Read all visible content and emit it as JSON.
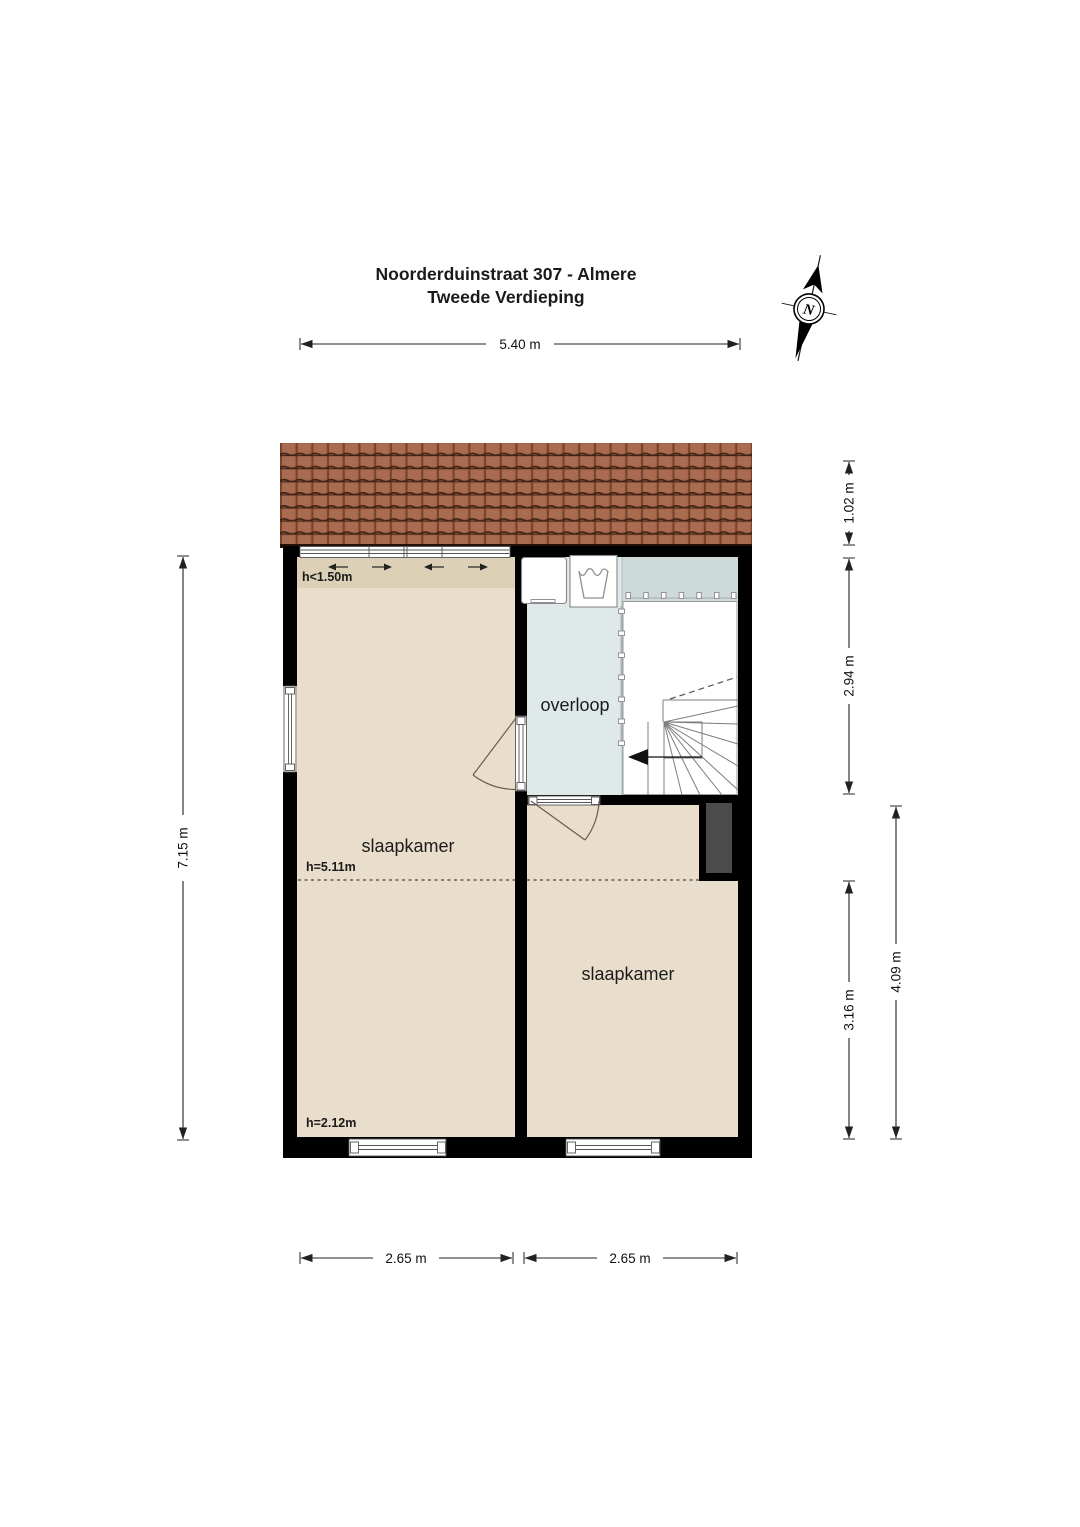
{
  "title": {
    "line1": "Noorderduinstraat 307 - Almere",
    "line2": "Tweede Verdieping"
  },
  "compass": {
    "label": "N"
  },
  "dims": {
    "top": "5.40 m",
    "left": "7.15 m",
    "right_roof": "1.02 m",
    "right_landing": "2.94 m",
    "right_room": "3.16 m",
    "right_total": "4.09 m",
    "bottom_left": "2.65 m",
    "bottom_right": "2.65 m"
  },
  "rooms": {
    "bedroom_left": {
      "label": "slaapkamer"
    },
    "bedroom_right": {
      "label": "slaapkamer"
    },
    "landing": {
      "label": "overloop"
    }
  },
  "notes": {
    "low_headroom": "h<1.50m",
    "ridge_height": "h=5.11m",
    "knee_height": "h=2.12m"
  },
  "colors": {
    "wall": "#000000",
    "bedroom_floor": "#e9decb",
    "bedroom_floor_low": "#dcd1b7",
    "landing_floor": "#dfe9e9",
    "stair_top_floor": "#ccdada",
    "chimney": "#4b4b4b",
    "roof_tile": "#a2644a"
  }
}
